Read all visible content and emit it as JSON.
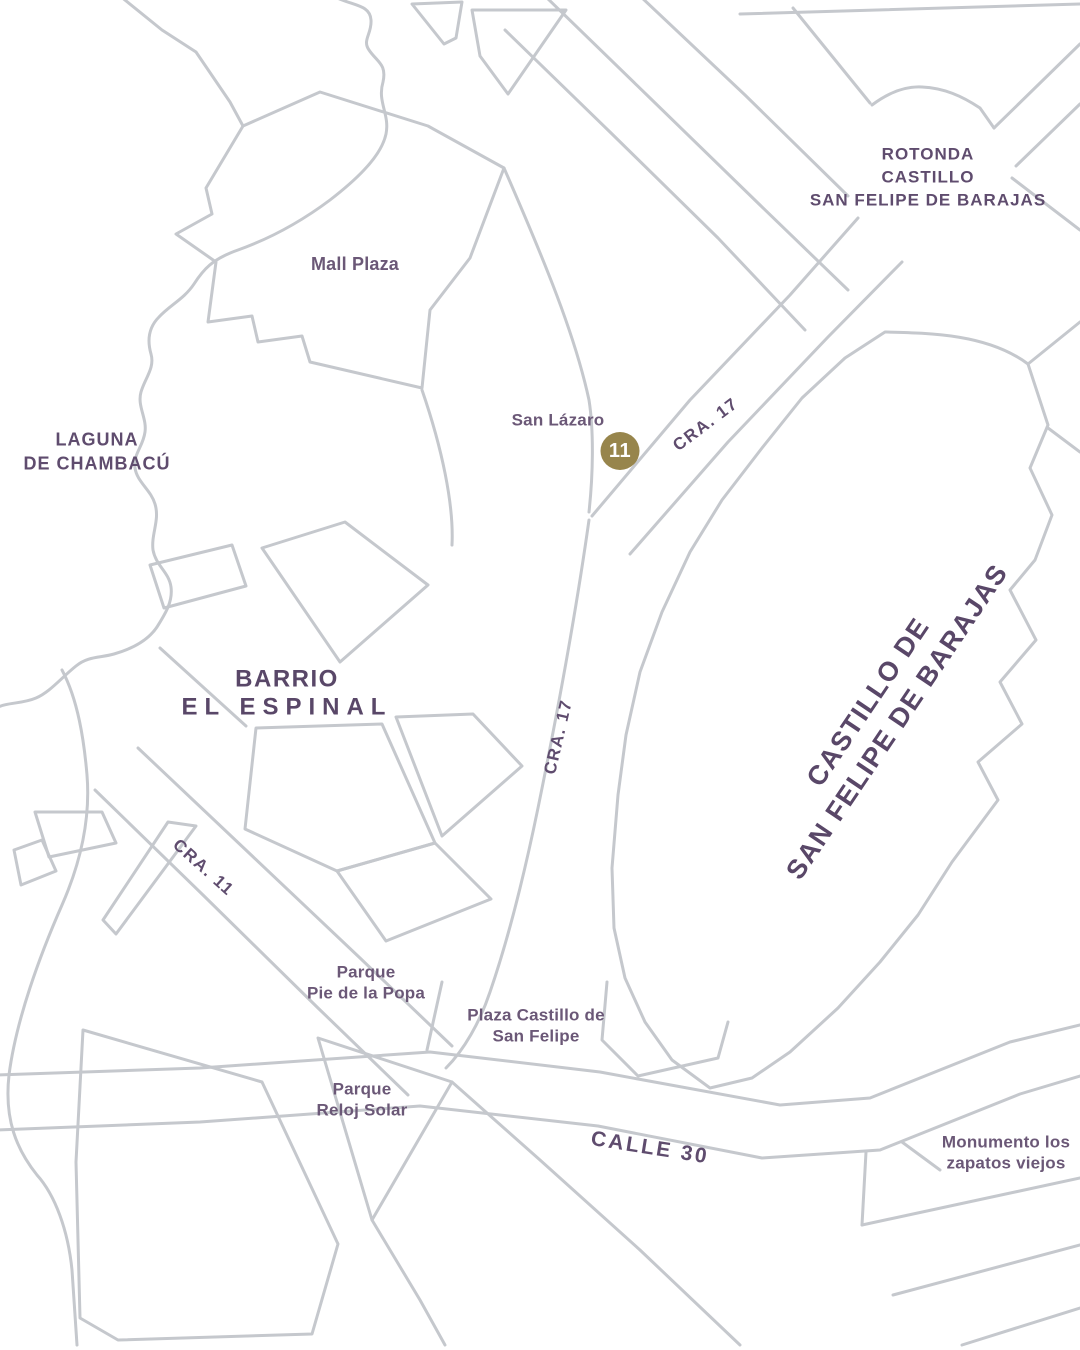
{
  "map": {
    "colors": {
      "background": "#ffffff",
      "road": "#c5c8cd",
      "label_regular": "#6b5877",
      "label_strong": "#594768",
      "marker_fill": "#97854c",
      "marker_text": "#ffffff"
    },
    "marker": {
      "number": "11"
    },
    "labels": {
      "rotonda": {
        "line1": "ROTONDA",
        "line2": "CASTILLO",
        "line3": "SAN FELIPE DE BARAJAS"
      },
      "mall_plaza": {
        "text": "Mall Plaza"
      },
      "laguna": {
        "line1": "LAGUNA",
        "line2": "DE CHAMBACÚ"
      },
      "san_lazaro": {
        "text": "San Lázaro"
      },
      "cra17_upper": {
        "text": "CRA. 17"
      },
      "cra17_lower": {
        "text": "CRA. 17"
      },
      "barrio": {
        "line1": "BARRIO",
        "line2": "EL ESPINAL"
      },
      "castillo": {
        "line1": "CASTILLO DE",
        "line2": "SAN FELIPE DE BARAJAS"
      },
      "cra11": {
        "text": "CRA. 11"
      },
      "parque_popa": {
        "line1": "Parque",
        "line2": "Pie de la Popa"
      },
      "plaza_castillo": {
        "line1": "Plaza Castillo de",
        "line2": "San Felipe"
      },
      "parque_reloj": {
        "line1": "Parque",
        "line2": "Reloj Solar"
      },
      "calle30": {
        "text": "CALLE 30"
      },
      "monumento": {
        "line1": "Monumento los",
        "line2": "zapatos viejos"
      }
    }
  }
}
